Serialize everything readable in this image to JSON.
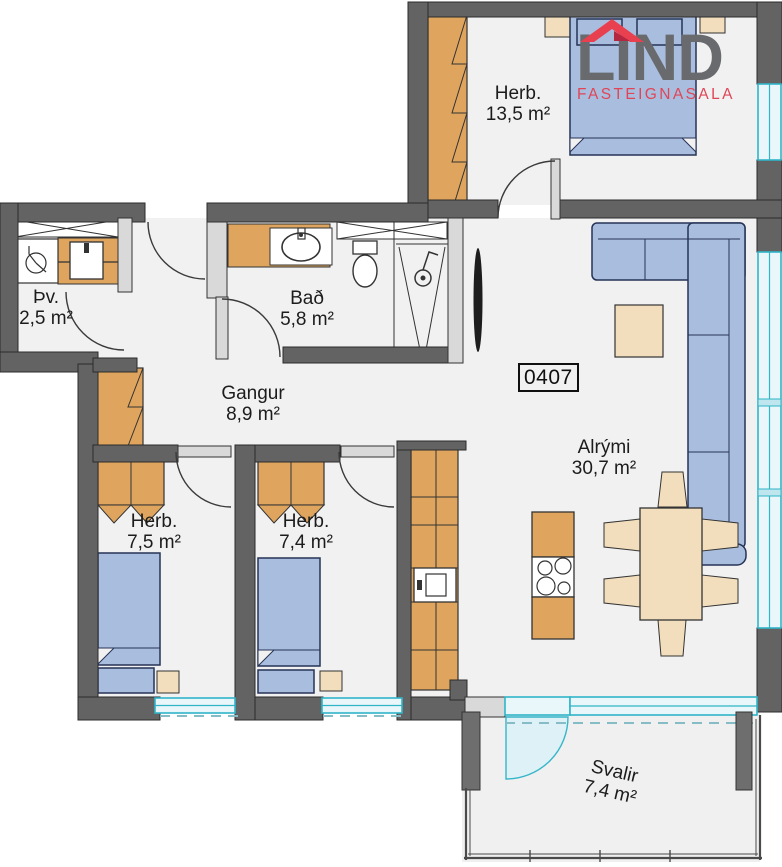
{
  "logo": {
    "title": "LIND",
    "subtitle": "FASTEIGNASALA",
    "title_color": "#686a6d",
    "subtitle_color": "#e04557",
    "roof_icon_color": "#e8404f"
  },
  "unit_number": "0407",
  "rooms": {
    "herb_top": {
      "label": "Herb.",
      "area": "13,5 m²"
    },
    "thv": {
      "label": "Þv.",
      "area": "2,5 m²"
    },
    "bad": {
      "label": "Bað",
      "area": "5,8 m²"
    },
    "gangur": {
      "label": "Gangur",
      "area": "8,9 m²"
    },
    "alrymi": {
      "label": "Alrými",
      "area": "30,7 m²"
    },
    "herb_1": {
      "label": "Herb.",
      "area": "7,5 m²"
    },
    "herb_2": {
      "label": "Herb.",
      "area": "7,4 m²"
    },
    "svalir": {
      "label": "Svalir",
      "area": "7,4 m²"
    }
  },
  "palette": {
    "wall": "#636363",
    "floor": "#f1f1f1",
    "furniture_blue": "#a9bede",
    "wood": "#dfa55e",
    "light_wood": "#f2debc",
    "window_cyan": "#2fb5c8",
    "text": "#1c1c1c"
  }
}
